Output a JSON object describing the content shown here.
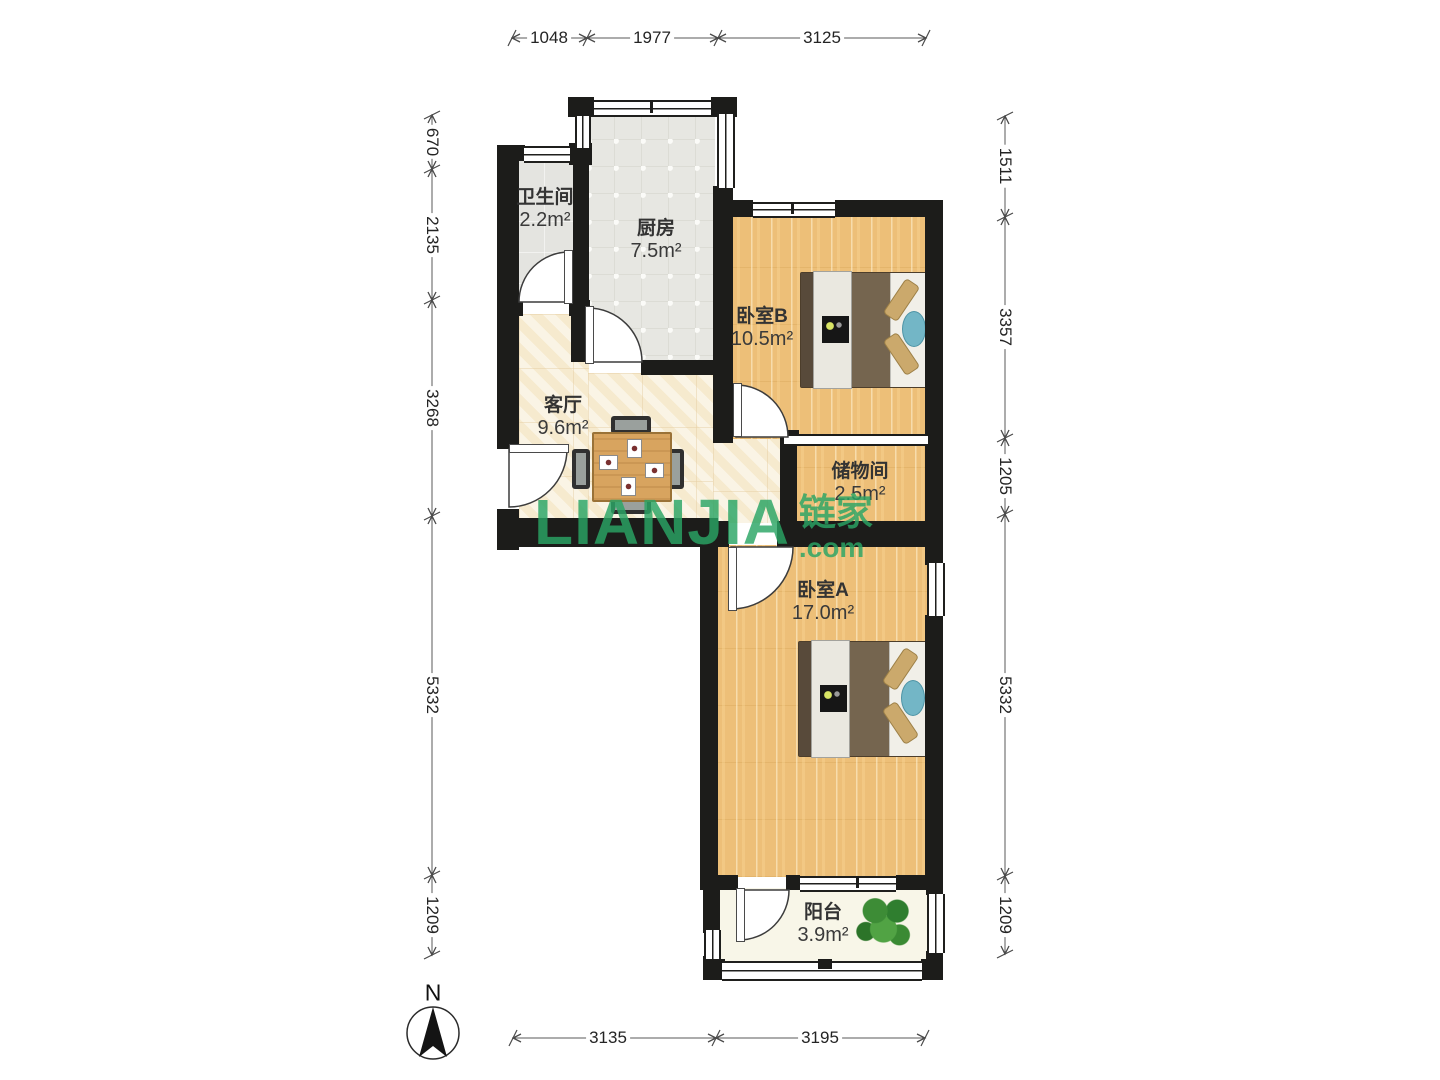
{
  "compass": {
    "label": "N"
  },
  "watermark": {
    "brand": "LIANJIA",
    "suffix": ".com",
    "cn": "链家"
  },
  "rooms": [
    {
      "name": "卫生间",
      "area": "2.2m²"
    },
    {
      "name": "厨房",
      "area": "7.5m²"
    },
    {
      "name": "卧室B",
      "area": "10.5m²"
    },
    {
      "name": "客厅",
      "area": "9.6m²"
    },
    {
      "name": "储物间",
      "area": "2.5m²"
    },
    {
      "name": "卧室A",
      "area": "17.0m²"
    },
    {
      "name": "阳台",
      "area": "3.9m²"
    }
  ],
  "dimensions": {
    "top": [
      "1048",
      "1977",
      "3125"
    ],
    "bottom": [
      "3135",
      "3195"
    ],
    "left": [
      "670",
      "2135",
      "3268",
      "5332",
      "1209"
    ],
    "right": [
      "1511",
      "3357",
      "1205",
      "5332",
      "1209"
    ]
  },
  "colors": {
    "wall": "#1c1c1a",
    "wood_floor": "#edbf78",
    "cream_floor": "#f8eed7",
    "tile_floor": "#e7e7e2",
    "balcony_floor": "#f8f6e8",
    "watermark_green": "#2aa565"
  }
}
